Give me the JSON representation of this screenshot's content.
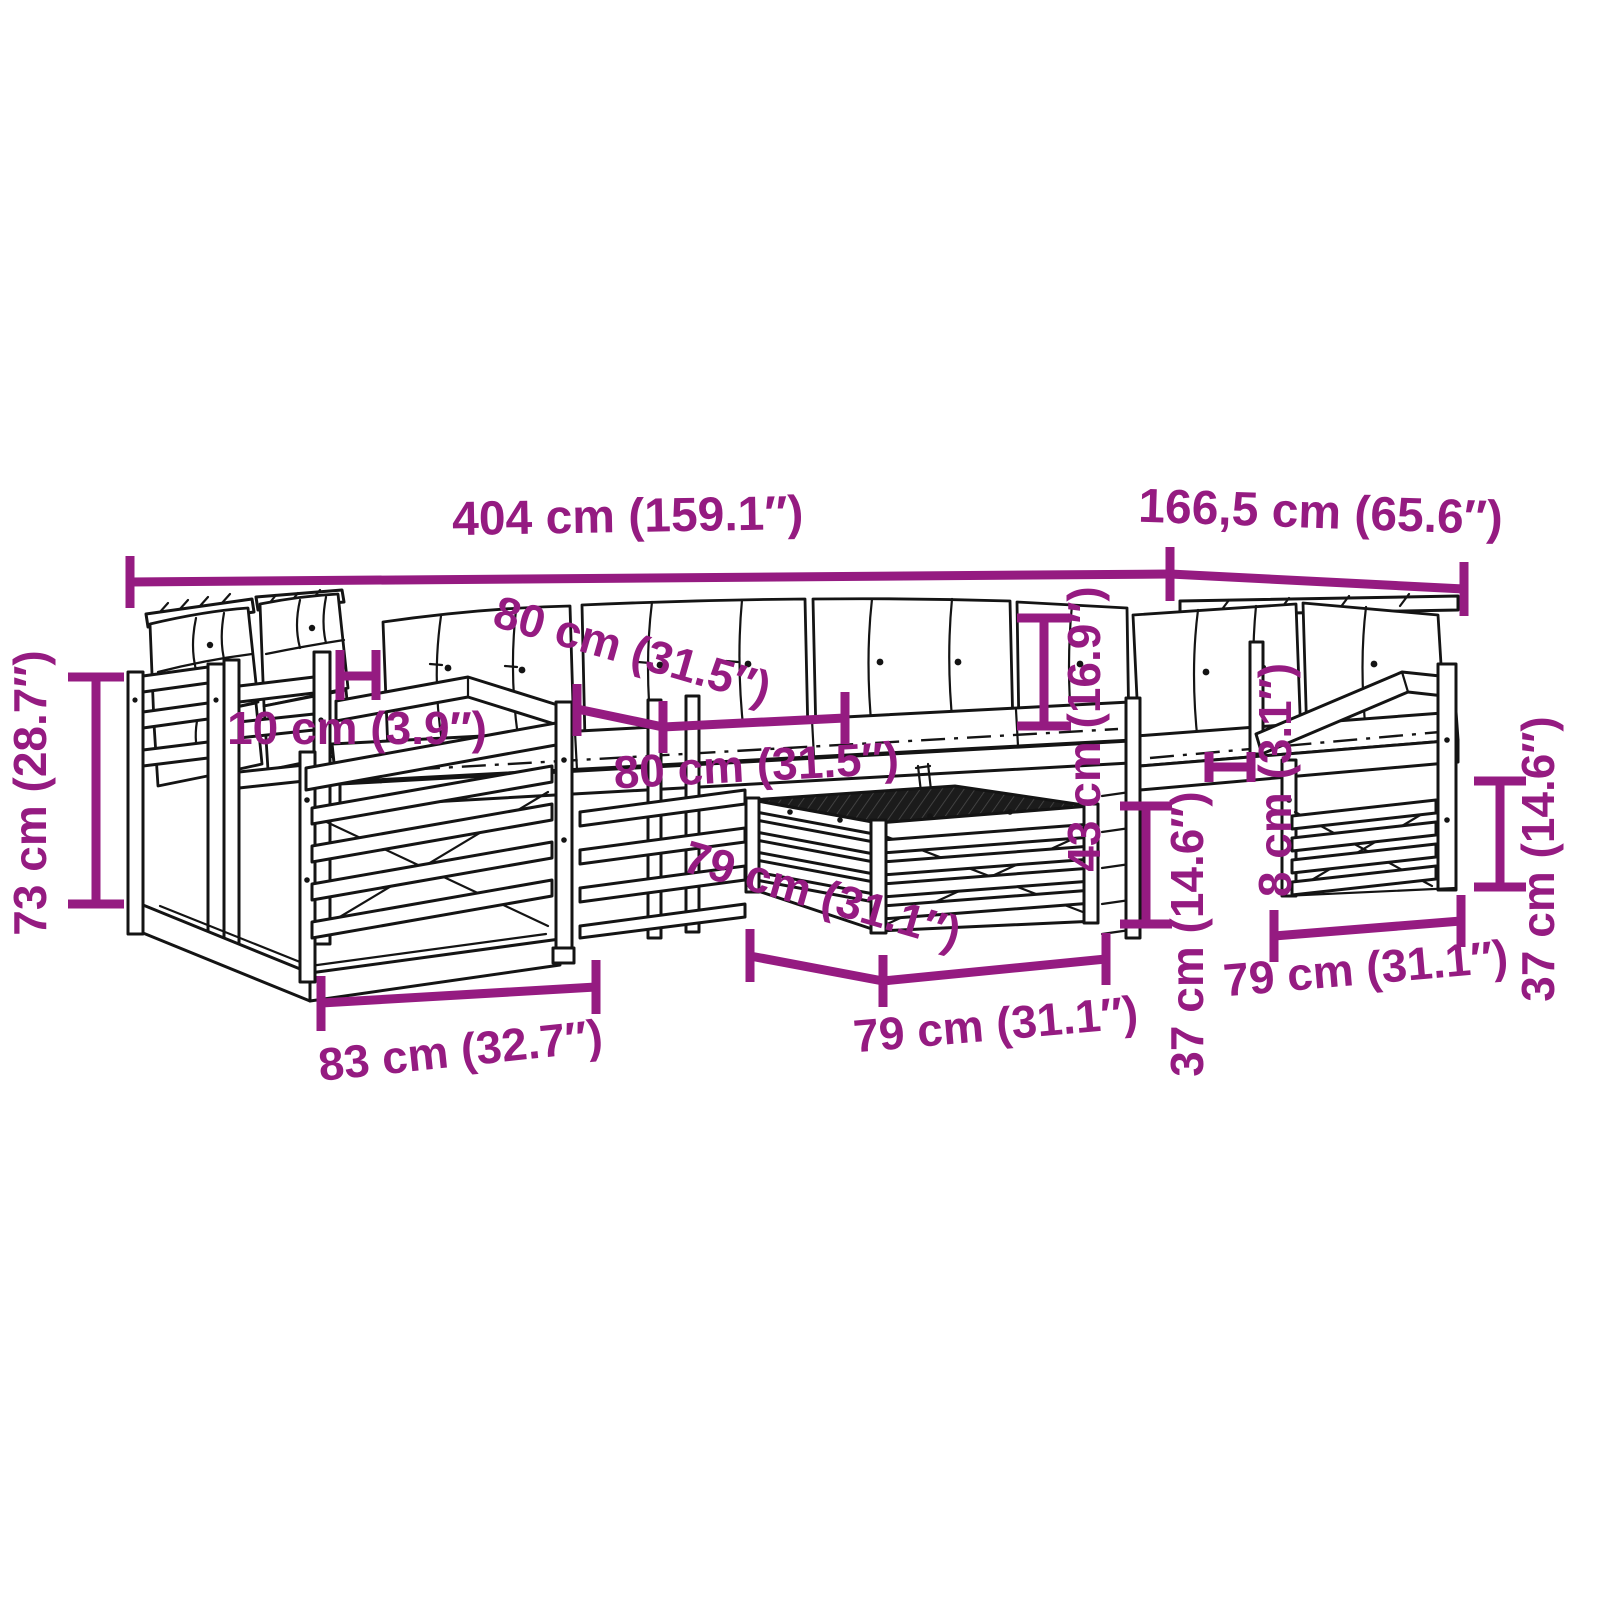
{
  "diagram": {
    "kind": "product-dimension-line-drawing",
    "subject": "modular garden lounge set with cushions and coffee table",
    "background": "#ffffff",
    "accent_color": "#951B81",
    "line_color": "#141414",
    "labels": {
      "total_width": "404 cm (159.1″)",
      "total_depth": "166,5 cm (65.6″)",
      "overall_height": "73 cm (28.7″)",
      "armrest_width": "10 cm (3.9″)",
      "module_width_back": "80 cm (31.5″)",
      "module_width_seat": "80 cm (31.5″)",
      "backrest_height": "43 cm (16.9″)",
      "table_depth": "79 cm (31.1″)",
      "table_width": "79 cm (31.1″)",
      "armchair_depth": "83 cm (32.7″)",
      "cushion_thickness": "8 cm (3.1″)",
      "seat_height_center": "37 cm (14.6″)",
      "seat_height_right": "37 cm (14.6″)",
      "module_width_right": "79 cm (31.1″)"
    }
  }
}
